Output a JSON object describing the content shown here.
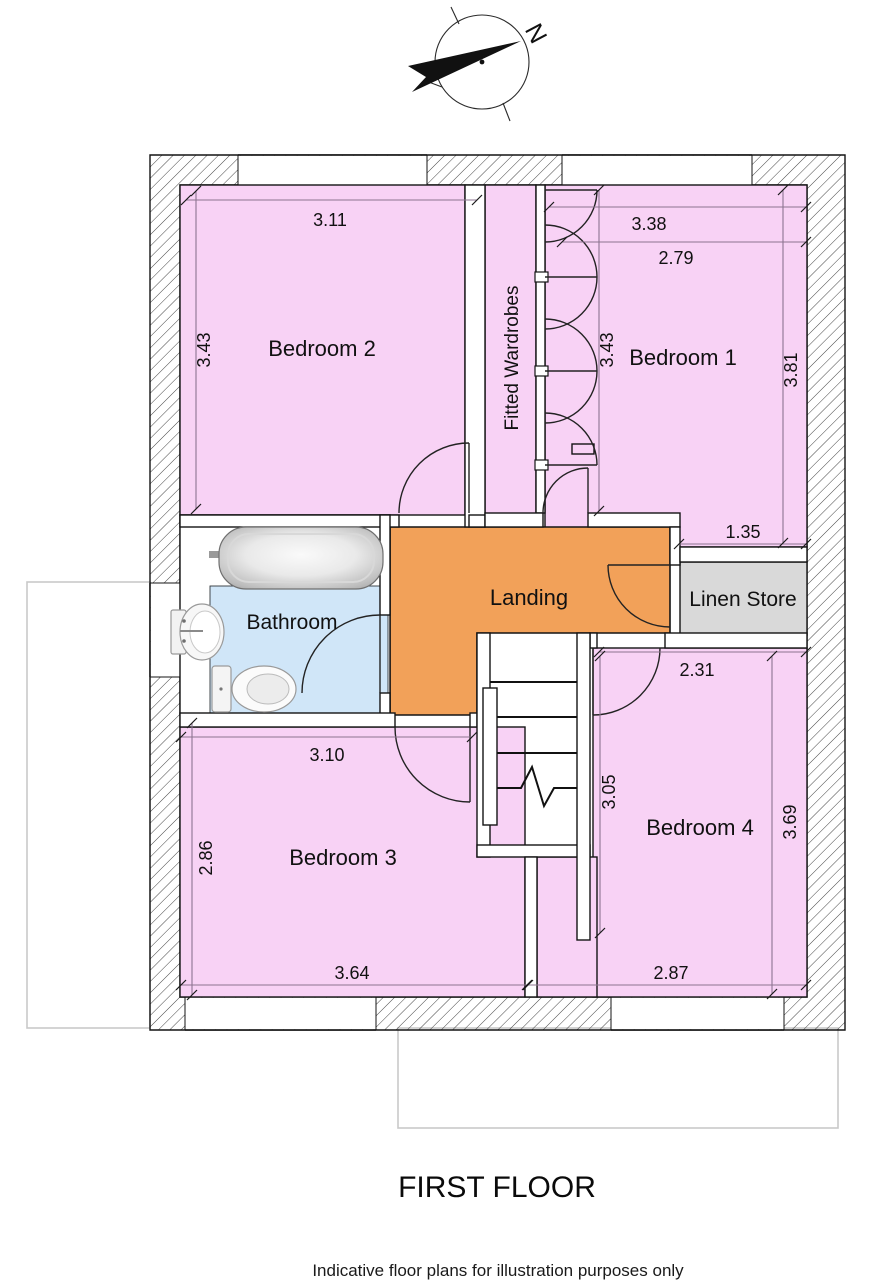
{
  "title": "FIRST FLOOR",
  "disclaimer": "Indicative floor plans for illustration purposes only",
  "compass": {
    "north_label": "N"
  },
  "rooms": {
    "bedroom2": {
      "label": "Bedroom 2"
    },
    "bedroom1": {
      "label": "Bedroom 1"
    },
    "fitted_wardrobes": {
      "label": "Fitted Wardrobes"
    },
    "bathroom": {
      "label": "Bathroom"
    },
    "landing": {
      "label": "Landing"
    },
    "linen_store": {
      "label": "Linen Store"
    },
    "bedroom3": {
      "label": "Bedroom 3"
    },
    "bedroom4": {
      "label": "Bedroom 4"
    }
  },
  "dimensions": {
    "bedroom2_width": "3.11",
    "bedroom2_depth": "3.43",
    "bedroom1_width_overall": "3.38",
    "bedroom1_width": "2.79",
    "bedroom1_depth_min": "3.43",
    "bedroom1_depth_max": "3.81",
    "linen_store_width": "1.35",
    "bedroom4_width_min": "2.31",
    "bedroom4_depth_min": "3.05",
    "bedroom4_depth_max": "3.69",
    "bedroom4_width_max": "2.87",
    "bedroom3_width_min": "3.10",
    "bedroom3_depth": "2.86",
    "bedroom3_width_max": "3.64"
  },
  "colors": {
    "room_pink": "#f8d2f5",
    "landing_orange": "#f2a159",
    "bathroom_blue": "#d0e6f8",
    "linen_grey": "#d9d9d9",
    "dimension_line": "#8d7490",
    "outline_faint": "#c9c9c9"
  }
}
